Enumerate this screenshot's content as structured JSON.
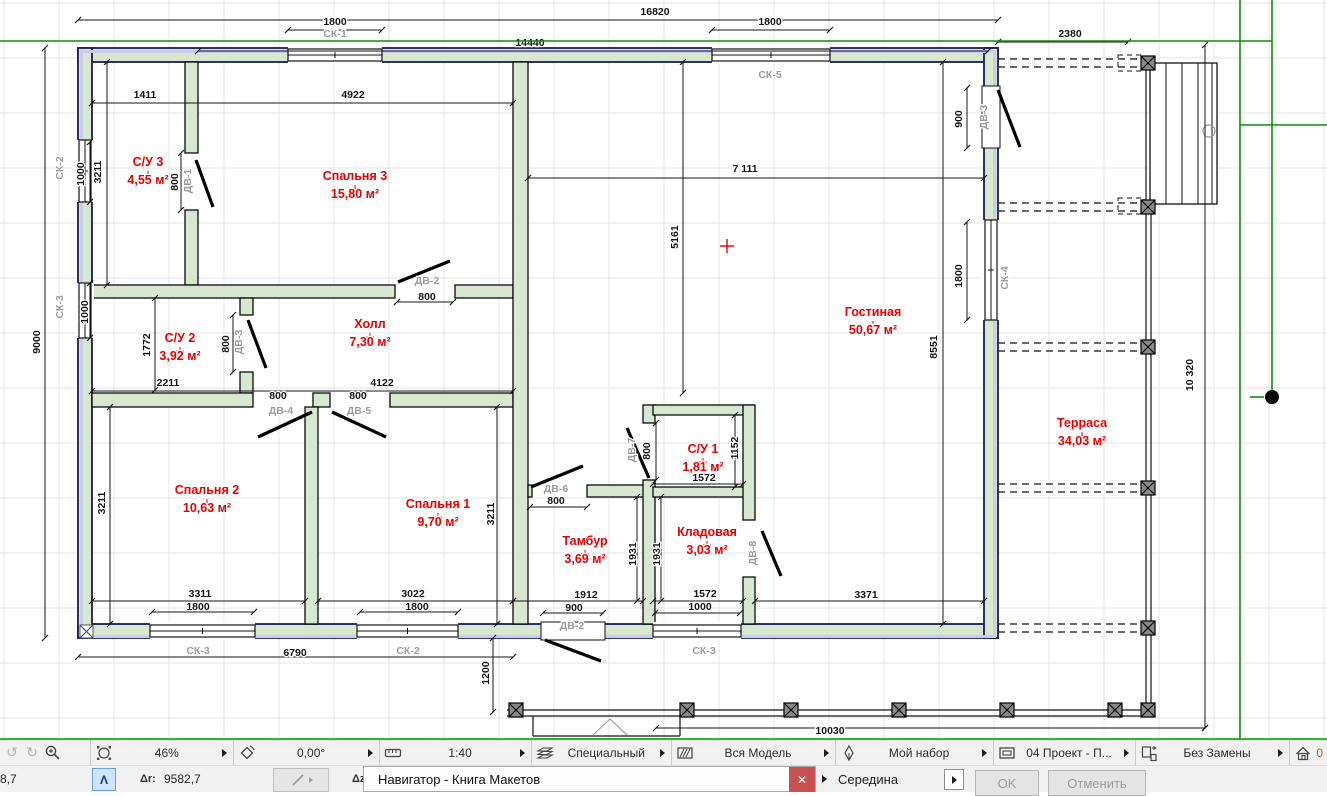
{
  "toolbar": {
    "zoom": "46%",
    "angle": "0,00°",
    "scale": "1:40",
    "layer_combination": "Специальный",
    "model_view": "Вся Модель",
    "pen_set": "Мой набор",
    "layout": "04 Проект - П...",
    "overrides": "Без Замены",
    "home_story": "0"
  },
  "statusbar": {
    "left_value": "8,7",
    "dr_label": "Δr:",
    "dr_value": "9582,7",
    "dz_label": "Δz:",
    "dialog_title": "Навигатор - Книга Макетов",
    "close_glyph": "✕",
    "snap_value": "Середина",
    "ok_label": "OK",
    "cancel_label": "Отменить",
    "caret_glyph": "Λ"
  },
  "plan": {
    "colors": {
      "wall_fill": "#d8e7cf",
      "band": "#c9cdeb",
      "ext_stroke": "#1c1c55",
      "int_stroke": "#0a0a0a",
      "red": "#e60000",
      "gray": "#9b9b9b",
      "dim": "#141414",
      "grid": "#e5e5e5",
      "green": "#0b8f0b"
    },
    "rooms": [
      {
        "name": "С/У 3",
        "area": "4,55 м²",
        "x": 148,
        "y": 166
      },
      {
        "name": "Спальня 3",
        "area": "15,80 м²",
        "x": 355,
        "y": 180
      },
      {
        "name": "С/У 2",
        "area": "3,92 м²",
        "x": 180,
        "y": 342
      },
      {
        "name": "Холл",
        "area": "7,30 м²",
        "x": 370,
        "y": 328
      },
      {
        "name": "Спальня 2",
        "area": "10,63 м²",
        "x": 207,
        "y": 494
      },
      {
        "name": "Спальня 1",
        "area": "9,70 м²",
        "x": 438,
        "y": 508
      },
      {
        "name": "Гостиная",
        "area": "50,67 м²",
        "x": 873,
        "y": 316
      },
      {
        "name": "Тамбур",
        "area": "3,69 м²",
        "x": 585,
        "y": 545
      },
      {
        "name": "С/У 1",
        "area": "1,81 м²",
        "x": 703,
        "y": 453
      },
      {
        "name": "Кладовая",
        "area": "3,03 м²",
        "x": 707,
        "y": 536
      },
      {
        "name": "Терраса",
        "area": "34,03 м²",
        "x": 1082,
        "y": 427
      }
    ],
    "texts": [
      {
        "t": "16820",
        "x": 655,
        "y": 15
      },
      {
        "t": "2380",
        "x": 1070,
        "y": 37
      },
      {
        "t": "14440",
        "x": 530,
        "y": 46
      },
      {
        "t": "1800",
        "x": 335,
        "y": 25
      },
      {
        "t": "1800",
        "x": 770,
        "y": 25
      },
      {
        "t": "СК-1",
        "x": 335,
        "y": 37,
        "g": 1
      },
      {
        "t": "СК-5",
        "x": 770,
        "y": 78,
        "g": 1
      },
      {
        "t": "1411",
        "x": 145,
        "y": 98
      },
      {
        "t": "4922",
        "x": 353,
        "y": 98
      },
      {
        "t": "3211",
        "x": 101,
        "y": 172,
        "r": 1
      },
      {
        "t": "1000",
        "x": 84,
        "y": 174,
        "r": 1
      },
      {
        "t": "9000",
        "x": 40,
        "y": 342,
        "r": 1
      },
      {
        "t": "СК-2",
        "x": 63,
        "y": 168,
        "r": 1,
        "g": 1
      },
      {
        "t": "СК-3",
        "x": 63,
        "y": 307,
        "r": 1,
        "g": 1
      },
      {
        "t": "800",
        "x": 178,
        "y": 182,
        "r": 1
      },
      {
        "t": "ДВ-1",
        "x": 191,
        "y": 181,
        "r": 1,
        "g": 1
      },
      {
        "t": "1772",
        "x": 150,
        "y": 345,
        "r": 1
      },
      {
        "t": "1000",
        "x": 88,
        "y": 312,
        "r": 1
      },
      {
        "t": "2211",
        "x": 168,
        "y": 386
      },
      {
        "t": "4122",
        "x": 382,
        "y": 386
      },
      {
        "t": "800",
        "x": 229,
        "y": 344,
        "r": 1
      },
      {
        "t": "ДВ-3",
        "x": 242,
        "y": 342,
        "r": 1,
        "g": 1
      },
      {
        "t": "ДВ-2",
        "x": 427,
        "y": 284,
        "g": 1
      },
      {
        "t": "800",
        "x": 427,
        "y": 300
      },
      {
        "t": "800",
        "x": 278,
        "y": 399
      },
      {
        "t": "ДВ-4",
        "x": 281,
        "y": 414,
        "g": 1
      },
      {
        "t": "800",
        "x": 358,
        "y": 399
      },
      {
        "t": "ДВ-5",
        "x": 359,
        "y": 414,
        "g": 1
      },
      {
        "t": "3211",
        "x": 105,
        "y": 503,
        "r": 1
      },
      {
        "t": "3211",
        "x": 494,
        "y": 514,
        "r": 1
      },
      {
        "t": "3311",
        "x": 200,
        "y": 597
      },
      {
        "t": "1800",
        "x": 198,
        "y": 610
      },
      {
        "t": "3022",
        "x": 413,
        "y": 597
      },
      {
        "t": "1800",
        "x": 417,
        "y": 610
      },
      {
        "t": "СК-3",
        "x": 198,
        "y": 654,
        "g": 1
      },
      {
        "t": "6790",
        "x": 295,
        "y": 656
      },
      {
        "t": "СК-2",
        "x": 408,
        "y": 654,
        "g": 1
      },
      {
        "t": "7 111",
        "x": 745,
        "y": 172
      },
      {
        "t": "5161",
        "x": 678,
        "y": 237,
        "r": 1
      },
      {
        "t": "8551",
        "x": 937,
        "y": 347,
        "r": 1
      },
      {
        "t": "900",
        "x": 962,
        "y": 119,
        "r": 1
      },
      {
        "t": "ДВ-3",
        "x": 987,
        "y": 117,
        "r": 1,
        "g": 1
      },
      {
        "t": "1800",
        "x": 962,
        "y": 276,
        "r": 1
      },
      {
        "t": "СК-4",
        "x": 1008,
        "y": 278,
        "r": 1,
        "g": 1
      },
      {
        "t": "1152",
        "x": 738,
        "y": 448,
        "r": 1
      },
      {
        "t": "1572",
        "x": 704,
        "y": 481
      },
      {
        "t": "ДВ-7",
        "x": 635,
        "y": 450,
        "r": 1,
        "g": 1
      },
      {
        "t": "800",
        "x": 650,
        "y": 451,
        "r": 1
      },
      {
        "t": "ДВ-6",
        "x": 556,
        "y": 492,
        "g": 1
      },
      {
        "t": "800",
        "x": 556,
        "y": 504
      },
      {
        "t": "1931",
        "x": 636,
        "y": 554,
        "r": 1
      },
      {
        "t": "1931",
        "x": 660,
        "y": 554,
        "r": 1
      },
      {
        "t": "ДВ-8",
        "x": 756,
        "y": 553,
        "r": 1,
        "g": 1
      },
      {
        "t": "1912",
        "x": 586,
        "y": 598
      },
      {
        "t": "900",
        "x": 574,
        "y": 611
      },
      {
        "t": "ДВ-2",
        "x": 572,
        "y": 629,
        "g": 1
      },
      {
        "t": "1572",
        "x": 705,
        "y": 597
      },
      {
        "t": "1000",
        "x": 700,
        "y": 610
      },
      {
        "t": "СК-3",
        "x": 704,
        "y": 654,
        "g": 1
      },
      {
        "t": "3371",
        "x": 866,
        "y": 598
      },
      {
        "t": "1200",
        "x": 489,
        "y": 673,
        "r": 1
      },
      {
        "t": "10030",
        "x": 830,
        "y": 734
      },
      {
        "t": "10 320",
        "x": 1193,
        "y": 375,
        "r": 1
      }
    ],
    "walls_ext": [
      [
        78,
        48,
        920,
        14
      ],
      [
        78,
        624,
        920,
        14
      ],
      [
        78,
        48,
        14,
        590
      ],
      [
        984,
        48,
        14,
        590
      ]
    ],
    "bands": [
      [
        80,
        50,
        916,
        3
      ],
      [
        80,
        635,
        916,
        3
      ],
      [
        80,
        50,
        3,
        586
      ],
      [
        993,
        50,
        3,
        586
      ]
    ],
    "walls_int": [
      [
        185,
        62,
        13,
        91
      ],
      [
        185,
        210,
        13,
        75
      ],
      [
        92,
        285,
        303,
        13
      ],
      [
        455,
        285,
        58,
        13
      ],
      [
        240,
        298,
        13,
        17
      ],
      [
        240,
        372,
        13,
        21
      ],
      [
        92,
        393,
        161,
        14
      ],
      [
        313,
        393,
        17,
        14
      ],
      [
        390,
        393,
        123,
        14
      ],
      [
        513,
        62,
        15,
        562
      ],
      [
        305,
        407,
        13,
        217
      ],
      [
        528,
        485,
        4,
        12
      ],
      [
        587,
        485,
        66,
        12
      ],
      [
        643,
        405,
        12,
        18
      ],
      [
        643,
        480,
        12,
        144
      ],
      [
        653,
        405,
        100,
        10
      ],
      [
        653,
        487,
        100,
        10
      ],
      [
        743,
        405,
        12,
        115
      ],
      [
        743,
        577,
        12,
        47
      ]
    ],
    "windows": [
      {
        "x": 288,
        "y": 46,
        "w": 94,
        "h": 18,
        "o": "h"
      },
      {
        "x": 712,
        "y": 46,
        "w": 118,
        "h": 18,
        "o": "h"
      },
      {
        "x": 76,
        "y": 140,
        "w": 18,
        "h": 62,
        "o": "v"
      },
      {
        "x": 76,
        "y": 283,
        "w": 18,
        "h": 55,
        "o": "v"
      },
      {
        "x": 982,
        "y": 220,
        "w": 18,
        "h": 100,
        "o": "v"
      },
      {
        "x": 150,
        "y": 622,
        "w": 105,
        "h": 18,
        "o": "h"
      },
      {
        "x": 357,
        "y": 622,
        "w": 101,
        "h": 18,
        "o": "h"
      },
      {
        "x": 653,
        "y": 622,
        "w": 88,
        "h": 18,
        "o": "h"
      }
    ],
    "whiteouts": [
      [
        982,
        86,
        18,
        62
      ],
      [
        541,
        622,
        64,
        18
      ]
    ],
    "leaves": [
      [
        196,
        160,
        213,
        207
      ],
      [
        398,
        282,
        450,
        261
      ],
      [
        248,
        320,
        266,
        368
      ],
      [
        258,
        437,
        312,
        412
      ],
      [
        332,
        412,
        386,
        437
      ],
      [
        531,
        487,
        583,
        466
      ],
      [
        627,
        428,
        649,
        478
      ],
      [
        762,
        531,
        781,
        576
      ],
      [
        998,
        90,
        1020,
        147
      ],
      [
        545,
        640,
        601,
        661
      ]
    ],
    "dimlines": [
      [
        78,
        20,
        998,
        20
      ],
      [
        998,
        42,
        1128,
        42
      ],
      [
        198,
        51,
        988,
        51
      ],
      [
        288,
        30,
        382,
        30
      ],
      [
        712,
        30,
        830,
        30
      ],
      [
        45,
        48,
        45,
        638
      ],
      [
        90,
        142,
        90,
        202
      ],
      [
        90,
        283,
        90,
        338
      ],
      [
        107,
        62,
        107,
        285
      ],
      [
        110,
        407,
        110,
        624
      ],
      [
        497,
        407,
        497,
        624
      ],
      [
        92,
        103,
        513,
        103
      ],
      [
        92,
        391,
        513,
        391
      ],
      [
        155,
        298,
        155,
        390
      ],
      [
        528,
        178,
        984,
        178
      ],
      [
        683,
        62,
        683,
        393
      ],
      [
        943,
        62,
        943,
        624
      ],
      [
        967,
        88,
        967,
        148
      ],
      [
        967,
        222,
        967,
        320
      ],
      [
        735,
        415,
        735,
        487
      ],
      [
        653,
        484,
        743,
        484
      ],
      [
        637,
        497,
        637,
        601
      ],
      [
        661,
        497,
        661,
        601
      ],
      [
        92,
        601,
        305,
        601
      ],
      [
        152,
        612,
        254,
        612
      ],
      [
        318,
        601,
        513,
        601
      ],
      [
        360,
        612,
        458,
        612
      ],
      [
        513,
        601,
        643,
        601
      ],
      [
        543,
        613,
        603,
        613
      ],
      [
        653,
        601,
        743,
        601
      ],
      [
        655,
        613,
        740,
        613
      ],
      [
        755,
        601,
        984,
        601
      ],
      [
        78,
        657,
        513,
        657
      ],
      [
        530,
        507,
        587,
        507
      ],
      [
        493,
        638,
        493,
        712
      ],
      [
        1205,
        45,
        1205,
        728
      ],
      [
        656,
        728,
        1205,
        728
      ],
      [
        397,
        302,
        453,
        302
      ],
      [
        181,
        153,
        181,
        210
      ],
      [
        233,
        315,
        233,
        372
      ],
      [
        656,
        423,
        656,
        480
      ]
    ],
    "lines": [
      [
        1146,
        57,
        1146,
        716
      ],
      [
        1151,
        57,
        1151,
        716
      ],
      [
        507,
        710,
        1151,
        710
      ],
      [
        507,
        716,
        1151,
        716
      ],
      [
        533,
        716,
        533,
        736
      ],
      [
        680,
        716,
        680,
        736
      ],
      [
        533,
        736,
        680,
        736
      ],
      [
        1166,
        63,
        1166,
        204
      ],
      [
        1182,
        63,
        1182,
        204
      ],
      [
        1198,
        63,
        1198,
        204
      ],
      [
        1212,
        63,
        1212,
        204
      ]
    ],
    "graylines": [
      [
        1159,
        131,
        1209,
        131
      ],
      [
        1172,
        114,
        1157,
        131
      ],
      [
        1157,
        131,
        1172,
        148
      ],
      [
        593,
        735,
        610,
        719
      ],
      [
        610,
        719,
        627,
        735
      ]
    ],
    "stairs_rect": [
      1150,
      63,
      67,
      141
    ],
    "gray_circle": [
      1209,
      131,
      6
    ],
    "dash_rows": [
      63,
      207,
      347,
      488,
      628
    ],
    "dash_rects": [
      [
        1118,
        55,
        26,
        16
      ],
      [
        1118,
        198,
        26,
        16
      ]
    ],
    "posts": [
      [
        516,
        710
      ],
      [
        687,
        710
      ],
      [
        791,
        710
      ],
      [
        899,
        710
      ],
      [
        1007,
        710
      ],
      [
        1115,
        710
      ],
      [
        1148,
        710
      ],
      [
        1148,
        63
      ],
      [
        1148,
        207
      ],
      [
        1148,
        347
      ],
      [
        1148,
        488
      ],
      [
        1148,
        628
      ]
    ],
    "origin": [
      80,
      625,
      13,
      13
    ],
    "cross": [
      727,
      246
    ],
    "guides": [
      [
        0,
        41,
        1272,
        41
      ],
      [
        1240,
        125,
        1327,
        125
      ],
      [
        1240,
        0,
        1240,
        738
      ],
      [
        1272,
        0,
        1272,
        397
      ],
      [
        1250,
        397,
        1264,
        397
      ]
    ],
    "node_dot": [
      1272,
      397,
      7
    ],
    "grid": {
      "step": 55,
      "ox": 4,
      "oy": 3
    }
  }
}
